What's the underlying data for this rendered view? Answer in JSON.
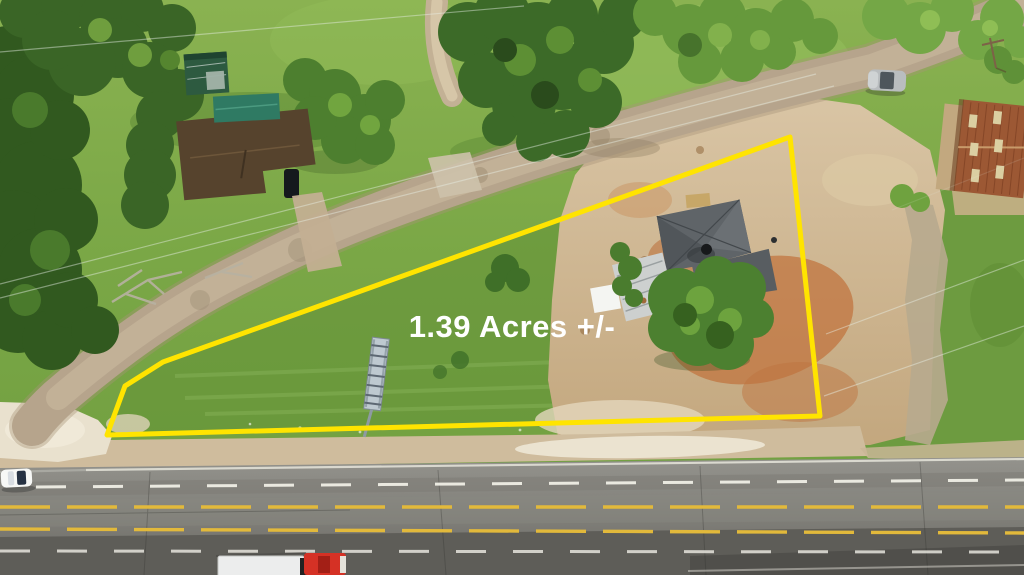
{
  "overlay": {
    "acreage_label": "1.39 Acres +/-"
  },
  "colors": {
    "boundary_yellow": "#ffe400",
    "label_white": "#ffffff",
    "lane_yellow": "#e2b93b",
    "lane_white": "#efeee6",
    "asphalt": "#8b8a85",
    "asphalt_dark": "#5e5d58",
    "grass_base": "#7fab49",
    "grass_property": "#5f8f36",
    "tree_green": "#3c6a28",
    "dirt_road": "#b6a48c",
    "dirt_field": "#cdb392",
    "dirt_orange": "#c0713a",
    "sand": "#e9e1ce",
    "roof_brown": "#56432d",
    "roof_teal": "#2f7a63",
    "roof_gray": "#5f6468",
    "roof_rust": "#9c5834",
    "shed_green": "#2d5a40",
    "truck_red": "#d53125",
    "trailer_white": "#eceded",
    "car_white": "#f7f8f6",
    "car_silver": "#b9bdbf"
  }
}
